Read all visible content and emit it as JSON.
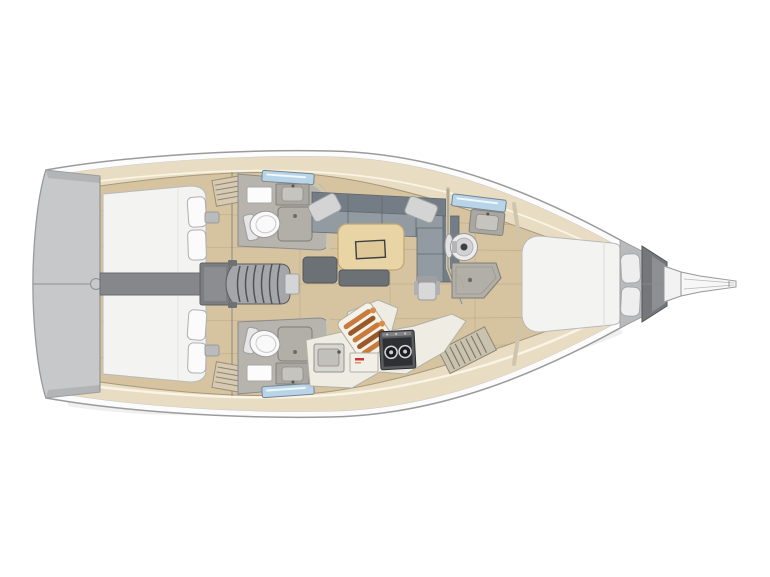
{
  "image": {
    "kind": "Sailing yacht interior floor plan (top-down deck layout), bow pointing right",
    "view": "top-down",
    "orientation": "bow-right, stern-left",
    "background": "white"
  },
  "colors": {
    "hullLine": "#9b9b9d",
    "hullFill": "#fcfcfd",
    "hullInnerLine": "#c9c9cb",
    "transom": "#c7c8ca",
    "transomEdge": "#a9abae",
    "deckTrim": "#e8ddc2",
    "trimHighlight": "#f9f4e6",
    "floorWood": "#d6c3a0",
    "floorSeam": "#b5a07b",
    "bedWhite": "#f3f3f2",
    "pillowWhite": "#fbfbfc",
    "sofaBack": "#747d85",
    "sofaSeat": "#929ba2",
    "sofaPillow": "#d3d4d3",
    "tableWood": "#e9d4a6",
    "tableEdge": "#c0a674",
    "trayLine": "#3e3e40",
    "benchGray": "#6b7175",
    "headFloor": "#b7b4ae",
    "wallBeige": "#cfc5ad",
    "fixtureGray": "#a9a7a1",
    "toiletWhite": "#f9f9f9",
    "windowBlue": "#b7d4e9",
    "windowFrame": "#76838e",
    "stairsFill": "#a4a6a9",
    "stairsLine": "#4c4e50",
    "engineGray": "#85878a",
    "engineBox": "#7b7d80",
    "anchorDark": "#76777a",
    "anchorLight": "#8e8f92",
    "copper": "#c77c3e",
    "copperDark": "#9a5a28",
    "copperLight": "#d98d4b",
    "stoveBody": "#5a5b5e",
    "stoveTop": "#2f3033",
    "burnerRing": "#d7d7d9",
    "counterIvory": "#efece3",
    "accentRed": "#cc3333"
  },
  "layout": {
    "stern": {
      "swim_platform": true,
      "centerline_hinge_circle": true
    },
    "aft_cabins": [
      {
        "id": "port-aft-cabin",
        "bed": "double berth",
        "pillows": 2,
        "wardrobe_louver": true
      },
      {
        "id": "starboard-aft-cabin",
        "bed": "double berth",
        "pillows": 2,
        "wardrobe_louver": true
      }
    ],
    "engine_compartment": "between aft cabins under companionway",
    "companionway": {
      "steps": 6
    },
    "heads": [
      {
        "id": "port-head",
        "fixtures": [
          "toilet",
          "sink",
          "mirror",
          "shower-pan",
          "hull-window"
        ]
      },
      {
        "id": "starboard-head",
        "fixtures": [
          "toilet",
          "sink",
          "mirror",
          "shower-pan",
          "hull-window"
        ]
      },
      {
        "id": "forward-head",
        "fixtures": [
          "round-basin",
          "sink-counter",
          "oval-mirror",
          "shower-pan",
          "hull-window"
        ]
      }
    ],
    "salon": {
      "sofa": "L-shaped settee on port side with two throw pillows",
      "table": "rectangular wood table with recessed tray",
      "benches": 2,
      "stool": 1
    },
    "galley": {
      "side": "starboard",
      "fixtures": [
        "sink",
        "two-burner-stove",
        "copper-bottle-rack",
        "locker-panel-red-logo",
        "slatted-step"
      ]
    },
    "forward_cabin": {
      "bed": "island double berth",
      "pillows": 2
    },
    "bow": {
      "anchor_locker": true,
      "bowsprit": true,
      "forestay_line": true
    }
  }
}
